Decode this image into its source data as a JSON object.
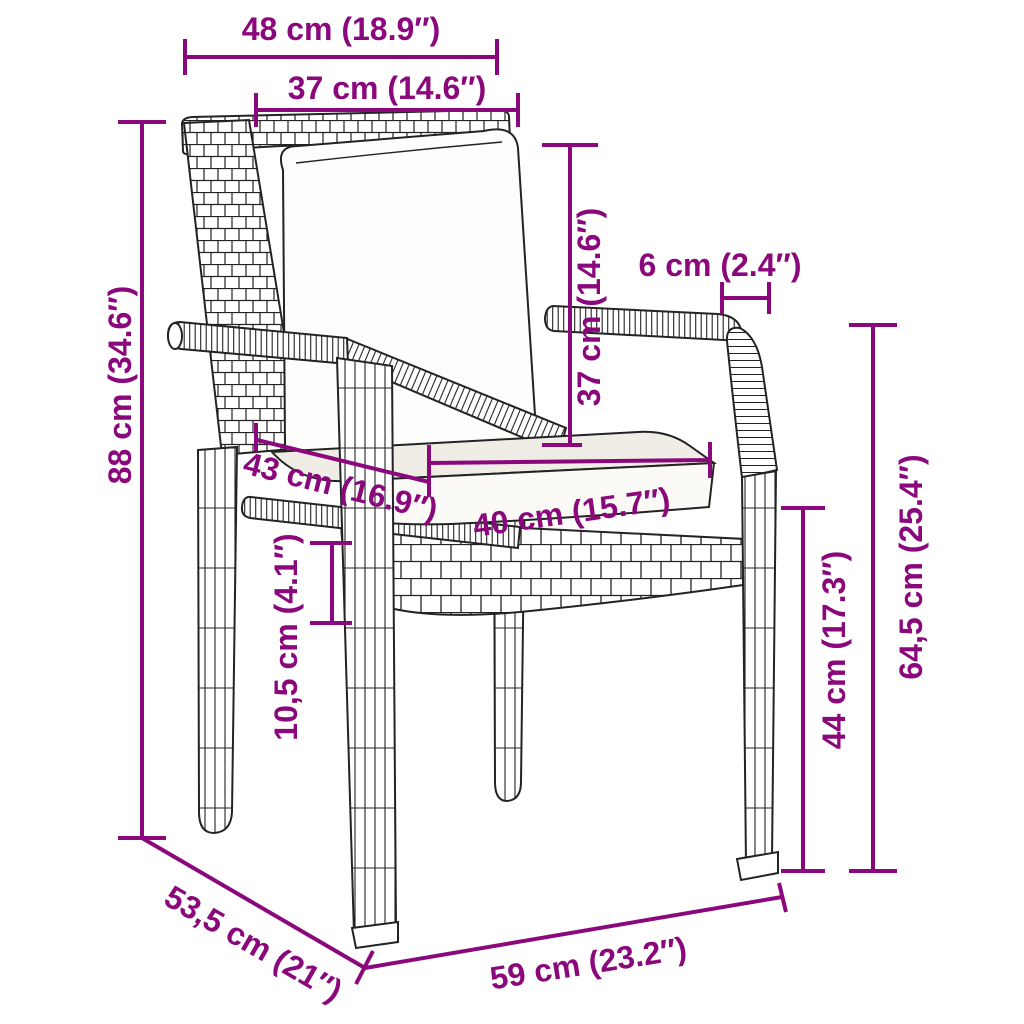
{
  "diagram": {
    "subject": "garden chair with cushions, poly rattan, line-art dimension drawing",
    "accent_color": "#8a087c",
    "line_color": "#232323",
    "background_color": "#ffffff"
  },
  "dimensions": [
    {
      "name": "overall-top-width",
      "label": "48 cm (18.9″)"
    },
    {
      "name": "backrest-inner-width",
      "label": "37 cm (14.6″)"
    },
    {
      "name": "armrest-width",
      "label": "6 cm (2.4″)"
    },
    {
      "name": "back-cushion-height",
      "label": "37 cm (14.6″)"
    },
    {
      "name": "overall-height",
      "label": "88 cm (34.6″)"
    },
    {
      "name": "seat-depth",
      "label": "43 cm (16.9″)"
    },
    {
      "name": "seat-cushion-width",
      "label": "40 cm (15.7″)"
    },
    {
      "name": "seat-frame-thickness",
      "label": "10,5 cm (4.1″)"
    },
    {
      "name": "seat-height",
      "label": "44 cm (17.3″)"
    },
    {
      "name": "armrest-height",
      "label": "64,5 cm (25.4″)"
    },
    {
      "name": "overall-depth",
      "label": "53,5 cm (21″)"
    },
    {
      "name": "overall-front-width",
      "label": "59 cm (23.2″)"
    }
  ]
}
